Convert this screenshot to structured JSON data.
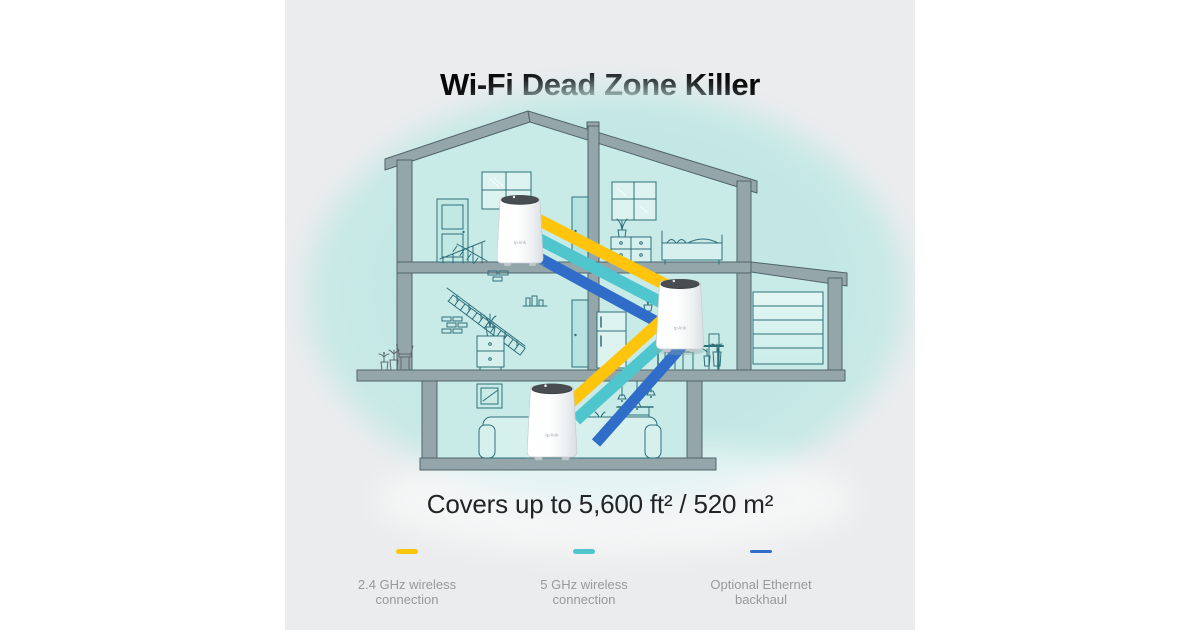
{
  "title": "Wi-Fi Dead Zone Killer",
  "coverage": "Covers up to 5,600 ft² / 520 m²",
  "legend": {
    "items": [
      {
        "label_line1": "2.4 GHz wireless",
        "label_line2": "connection",
        "color": "#FFC50D"
      },
      {
        "label_line1": "5 GHz wireless",
        "label_line2": "connection",
        "color": "#4FC6CD"
      },
      {
        "label_line1": "Optional Ethernet",
        "label_line2": "backhaul",
        "color": "#2F6DC9"
      }
    ]
  },
  "illustration": {
    "type": "house-cross-section",
    "unit_logo": "tp-link",
    "deco_units": [
      "attic-unit",
      "kitchen-unit",
      "living-room-unit"
    ],
    "link_colors": {
      "wireless_24ghz": "#FFC50D",
      "wireless_5ghz": "#4FC6CD",
      "ethernet_backhaul": "#2F6DC9"
    },
    "background_color": "#EBECED",
    "room_color": "#C8EBE8",
    "wall_color": "#94A6A9"
  }
}
